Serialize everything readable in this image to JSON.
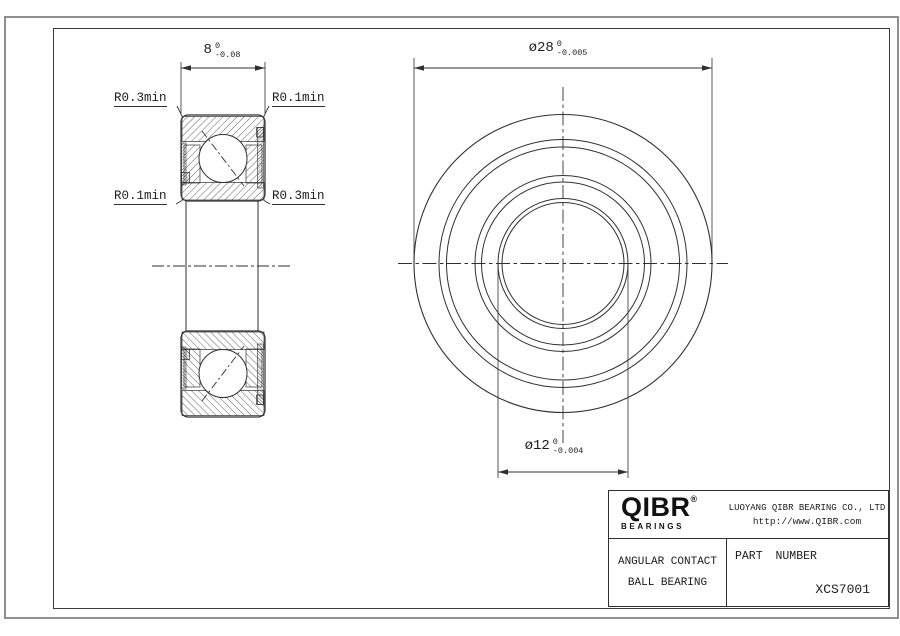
{
  "drawing": {
    "section_view": {
      "width_dim": {
        "value": "8",
        "tol_top": "0",
        "tol_bottom": "-0.08"
      },
      "corner_labels": {
        "top_left": "R0.3min",
        "top_right": "R0.1min",
        "bottom_left": "R0.1min",
        "bottom_right": "R0.3min"
      }
    },
    "front_view": {
      "outer_dim": {
        "value": "ø28",
        "tol_top": "0",
        "tol_bottom": "-0.005"
      },
      "bore_dim": {
        "value": "ø12",
        "tol_top": "0",
        "tol_bottom": "-0.004"
      }
    }
  },
  "title_block": {
    "logo": {
      "brand": "QIBR",
      "registered": "®",
      "tagline": "BEARINGS"
    },
    "company": "LUOYANG QIBR BEARING CO., LTD",
    "website": "http://www.QIBR.com",
    "product": {
      "line1": "ANGULAR CONTACT",
      "line2": "BALL BEARING"
    },
    "part_number_label": "PART NUMBER",
    "part_number": "XCS7001"
  },
  "colors": {
    "line": "#303030",
    "frame_outer": "#8f8f8f",
    "frame_inner": "#3a3a3a",
    "background": "#ffffff",
    "text": "#1c1c1c"
  }
}
